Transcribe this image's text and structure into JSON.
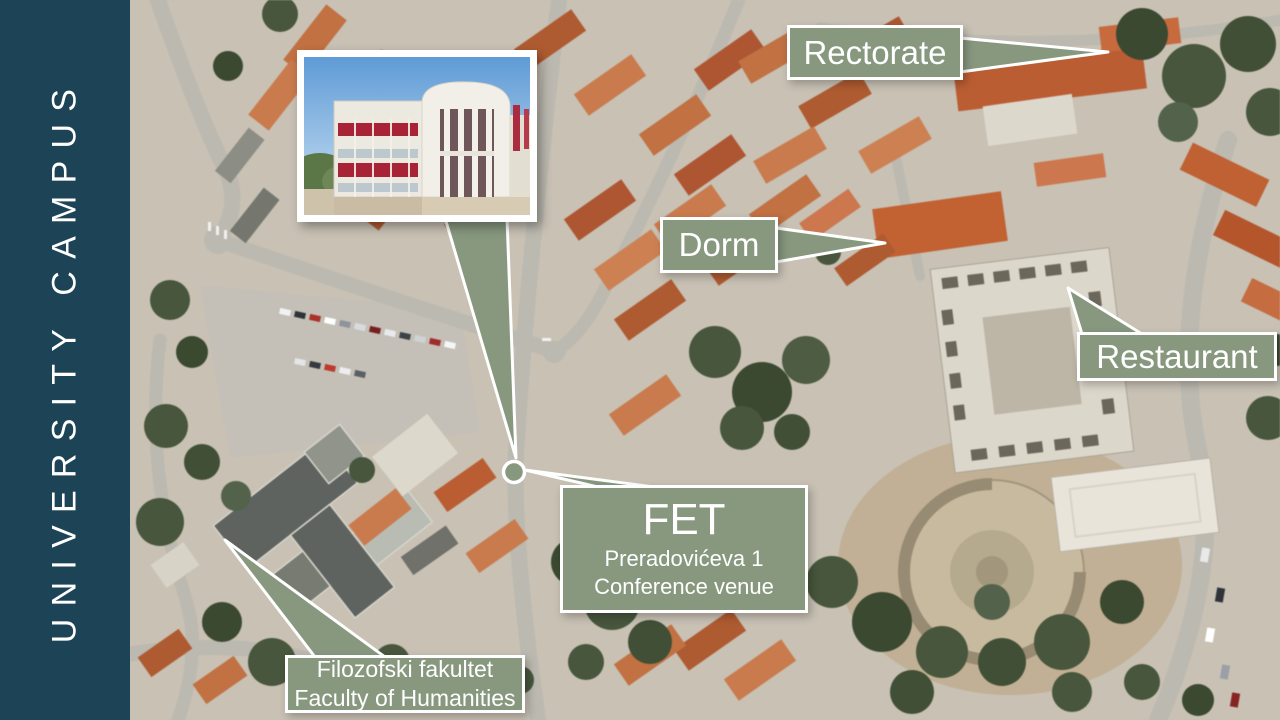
{
  "sidebar": {
    "title": "UNIVERSITY CAMPUS"
  },
  "callouts": {
    "rectorate": {
      "label": "Rectorate"
    },
    "dorm": {
      "label": "Dorm"
    },
    "restaurant": {
      "label": "Restaurant"
    },
    "fet": {
      "title": "FET",
      "address": "Preradovićeva 1",
      "subtitle": "Conference venue"
    },
    "faculty": {
      "line1": "Filozofski fakultet",
      "line2": "Faculty of Humanities"
    }
  },
  "colors": {
    "sidebar_bg": "#1c4356",
    "callout_bg": "#87987f",
    "callout_border": "#ffffff",
    "callout_text": "#ffffff",
    "map_base": "#c8c1b3",
    "roof_terracotta": "#c4703f",
    "tree_green": "#46563b"
  }
}
